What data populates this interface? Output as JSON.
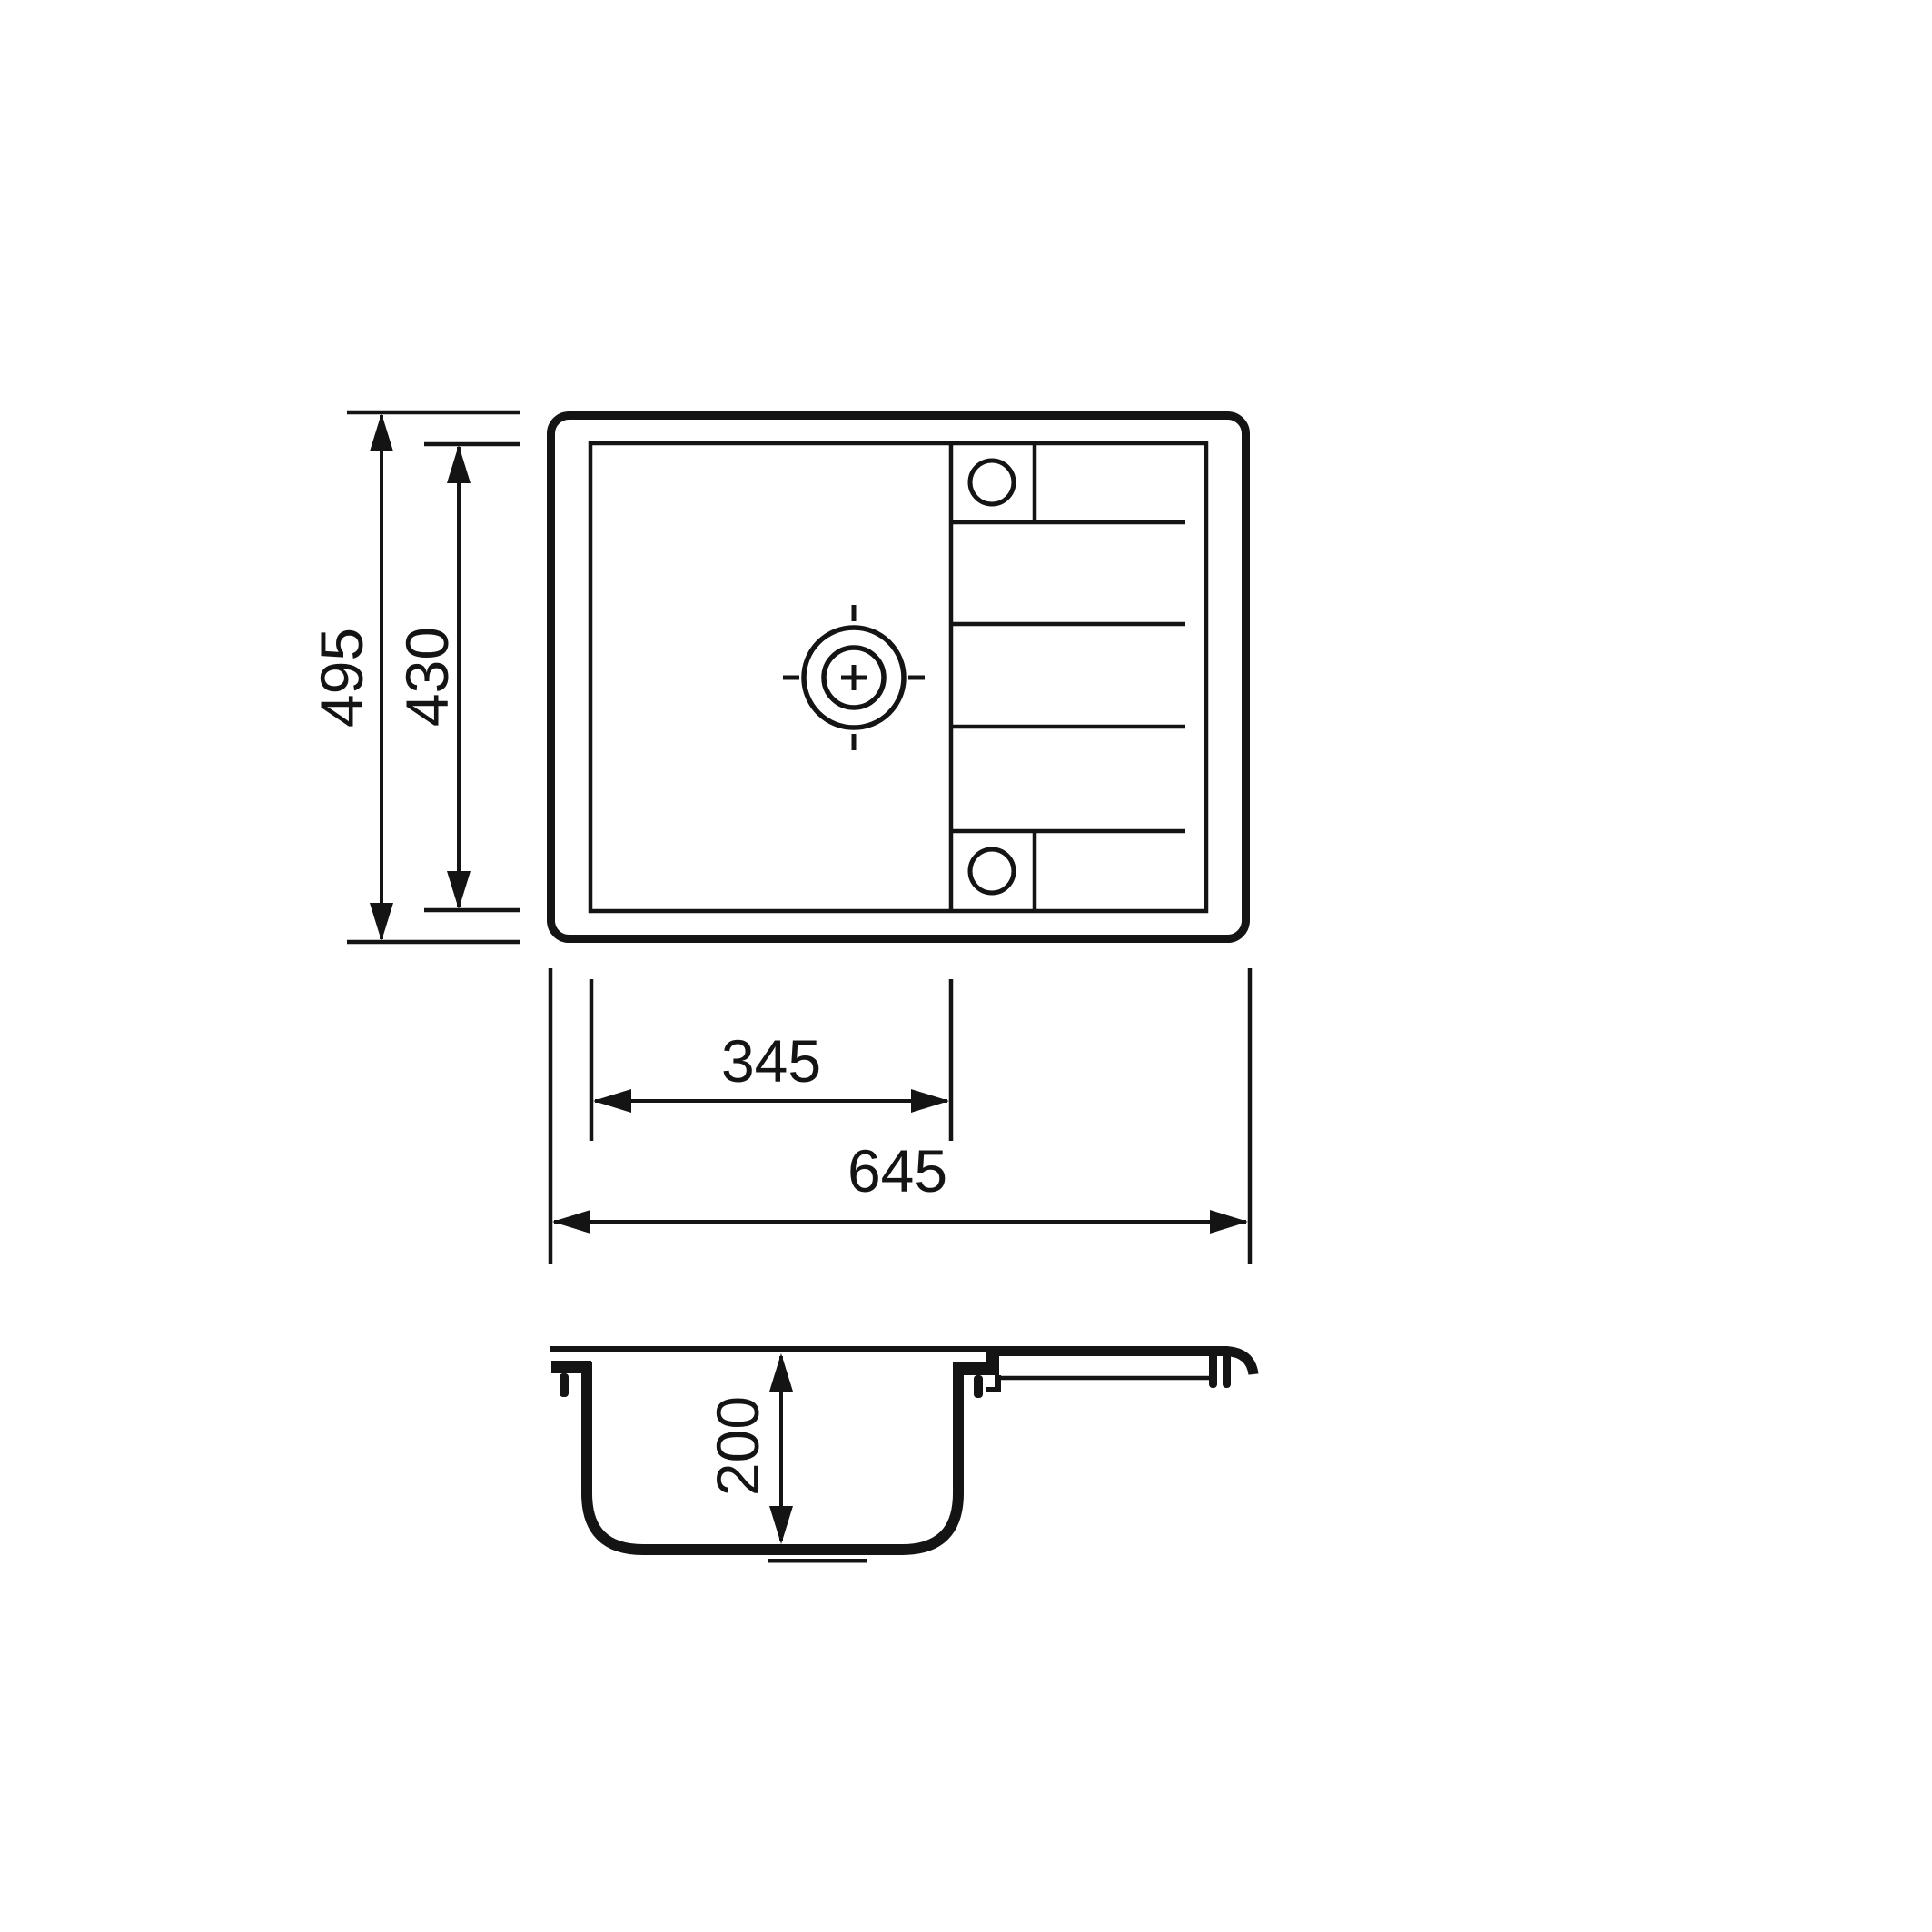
{
  "page": {
    "background": "#ffffff",
    "ink": "#141414",
    "description": "Technical dimension drawing of a kitchen sink with drainboard: plan (top) view and cross-section view"
  },
  "drawing": {
    "views": {
      "top_view": "plan view of sink with bowl, drainboard ribs and two tap holes",
      "section_view": "cross-section of bowl with mounting clips and drainboard profile"
    },
    "dimensions": {
      "overall_width": {
        "label": "645",
        "orientation": "horizontal"
      },
      "overall_depth": {
        "label": "495",
        "orientation": "vertical"
      },
      "cutout_depth": {
        "label": "430",
        "orientation": "vertical"
      },
      "bowl_width": {
        "label": "345",
        "orientation": "horizontal"
      },
      "bowl_depth": {
        "label": "200",
        "orientation": "vertical"
      }
    }
  }
}
